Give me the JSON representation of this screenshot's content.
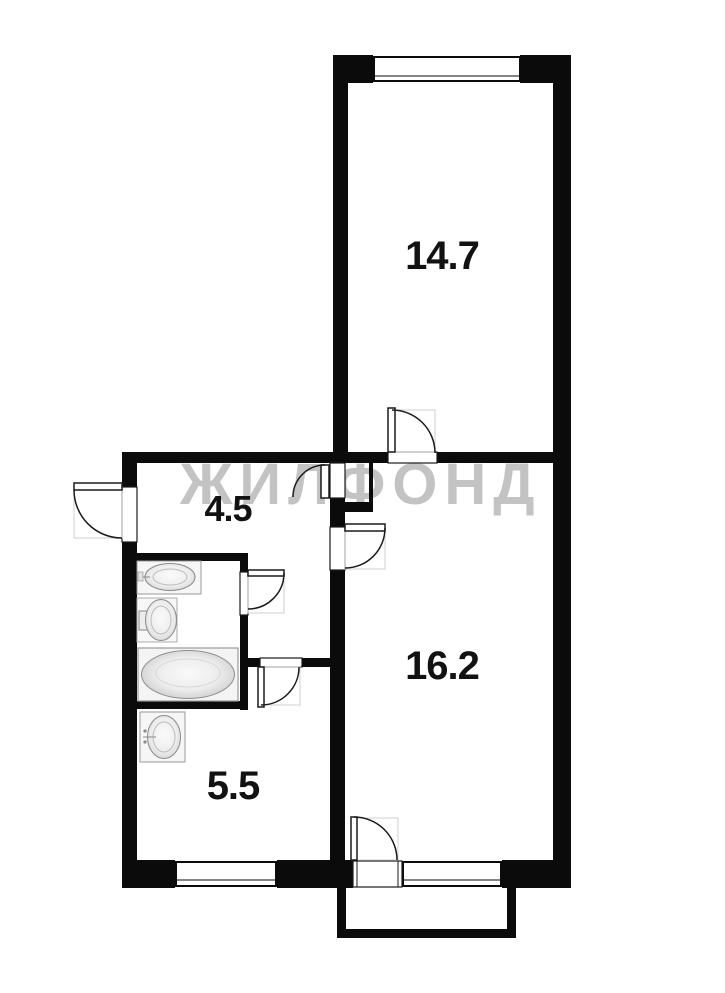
{
  "watermark": {
    "text": "ЖИЛФОНД",
    "color": "#c3c3c3"
  },
  "rooms": {
    "bedroom": {
      "area": "14.7"
    },
    "hall": {
      "area": "4.5"
    },
    "living": {
      "area": "16.2"
    },
    "kitchen": {
      "area": "5.5"
    }
  },
  "fixtures": [
    "sink-icon",
    "toilet-icon",
    "bathtub-icon",
    "kitchen-sink-icon"
  ],
  "colors": {
    "wall": "#0b0b0b",
    "floor": "#ffffff",
    "watermark": "#c3c3c3",
    "door_line": "#1a1a1a",
    "swing_box": "#cfcfcf",
    "fixture_fill": "#f5f5f5",
    "fixture_stroke": "#8f8f8f"
  }
}
